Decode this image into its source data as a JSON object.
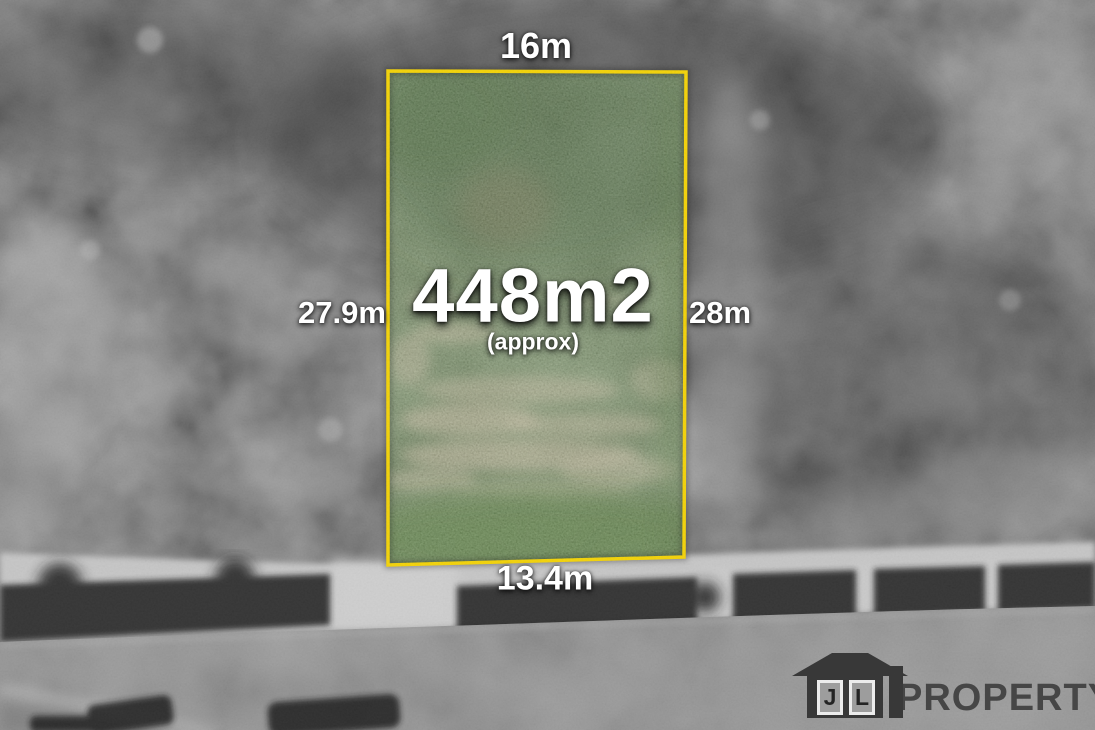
{
  "annotations": {
    "top_width": "16m",
    "left_depth": "27.9m",
    "right_depth": "28m",
    "bottom_width": "13.4m",
    "area": "448m2",
    "area_qualifier": "(approx)"
  },
  "branding": {
    "icon": "house-icon",
    "initial_j": "J",
    "initial_l": "L",
    "name": "PROPERTY"
  },
  "colors": {
    "lot_boundary": "#F6D400",
    "label_text": "#FFFFFF",
    "lot_grass": "#4C7030",
    "dirt_patch": "#C9BD9B",
    "logo_dark": "#2E2E2E"
  }
}
